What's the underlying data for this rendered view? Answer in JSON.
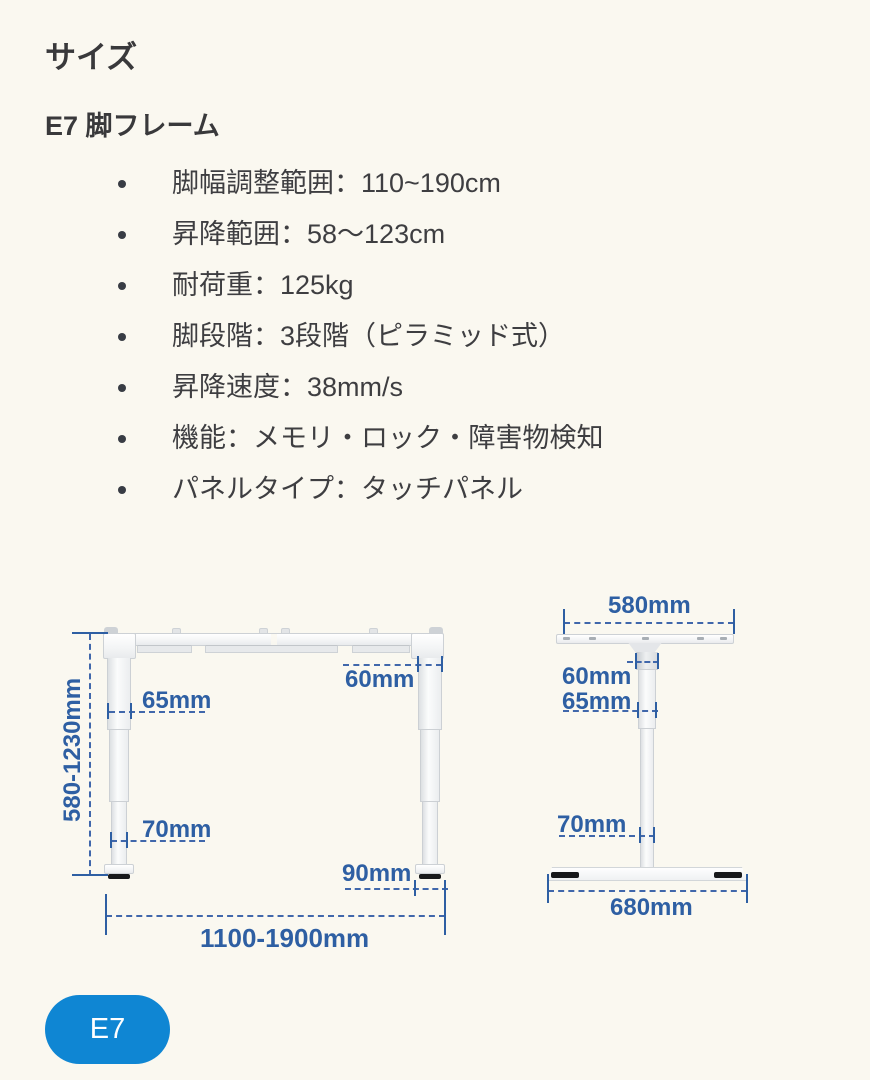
{
  "page": {
    "title": "サイズ",
    "subtitle": "E7 脚フレーム"
  },
  "specs": {
    "items": [
      "脚幅調整範囲：110~190cm",
      "昇降範囲：58〜123cm",
      "耐荷重：125kg",
      "脚段階：3段階（ピラミッド式）",
      "昇降速度：38mm/s",
      "機能：メモリ・ロック・障害物検知",
      "パネルタイプ：タッチパネル"
    ]
  },
  "diagram": {
    "front_view": {
      "leg_top_width": "60mm",
      "leg_upper_width": "65mm",
      "leg_lower_width": "70mm",
      "foot_glide_width": "90mm",
      "height_range": "580-1230mm",
      "width_range": "1100-1900mm"
    },
    "side_view": {
      "bracket_width": "580mm",
      "column_top_width": "60mm",
      "column_mid_width": "65mm",
      "column_bottom_width": "70mm",
      "foot_depth": "680mm"
    }
  },
  "footer": {
    "model_button": "E7"
  },
  "colors": {
    "dimension_blue": "#2e5fa3",
    "button_blue": "#0f86d3",
    "background": "#faf8f0",
    "text_dark": "#3b3b3d"
  }
}
